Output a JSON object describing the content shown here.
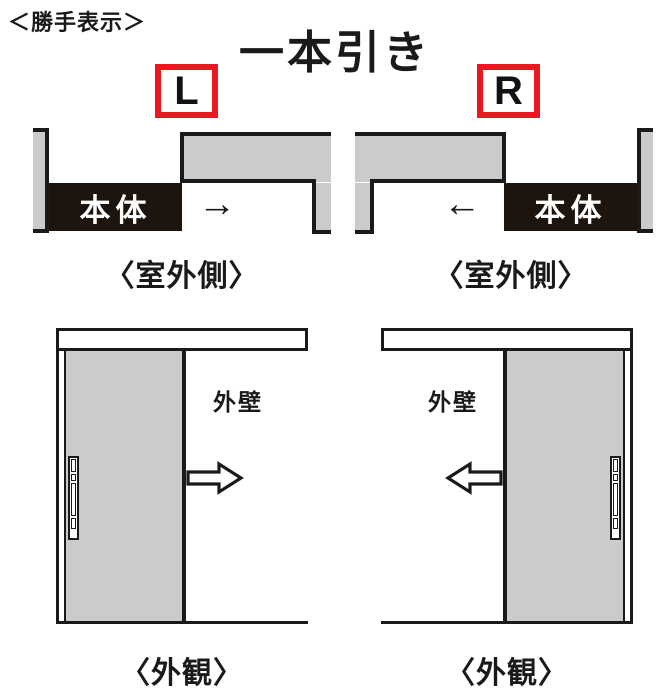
{
  "colors": {
    "accent_red": "#e8191f",
    "panel_gray": "#cbccc9",
    "line_black": "#1a1a1a",
    "body_black": "#1c140d",
    "background": "#ffffff"
  },
  "header": {
    "handing_note": "＜勝手表示＞",
    "title": "一本引き"
  },
  "diagrams": {
    "left": {
      "handing": "L",
      "plan": {
        "body_label": "本体",
        "arrow": "→",
        "caption": "〈室外側〉"
      },
      "elevation": {
        "wall_label": "外壁",
        "caption": "〈外観〉",
        "slide_direction": "right"
      }
    },
    "right": {
      "handing": "R",
      "plan": {
        "body_label": "本体",
        "arrow": "←",
        "caption": "〈室外側〉"
      },
      "elevation": {
        "wall_label": "外壁",
        "caption": "〈外観〉",
        "slide_direction": "left"
      }
    }
  }
}
